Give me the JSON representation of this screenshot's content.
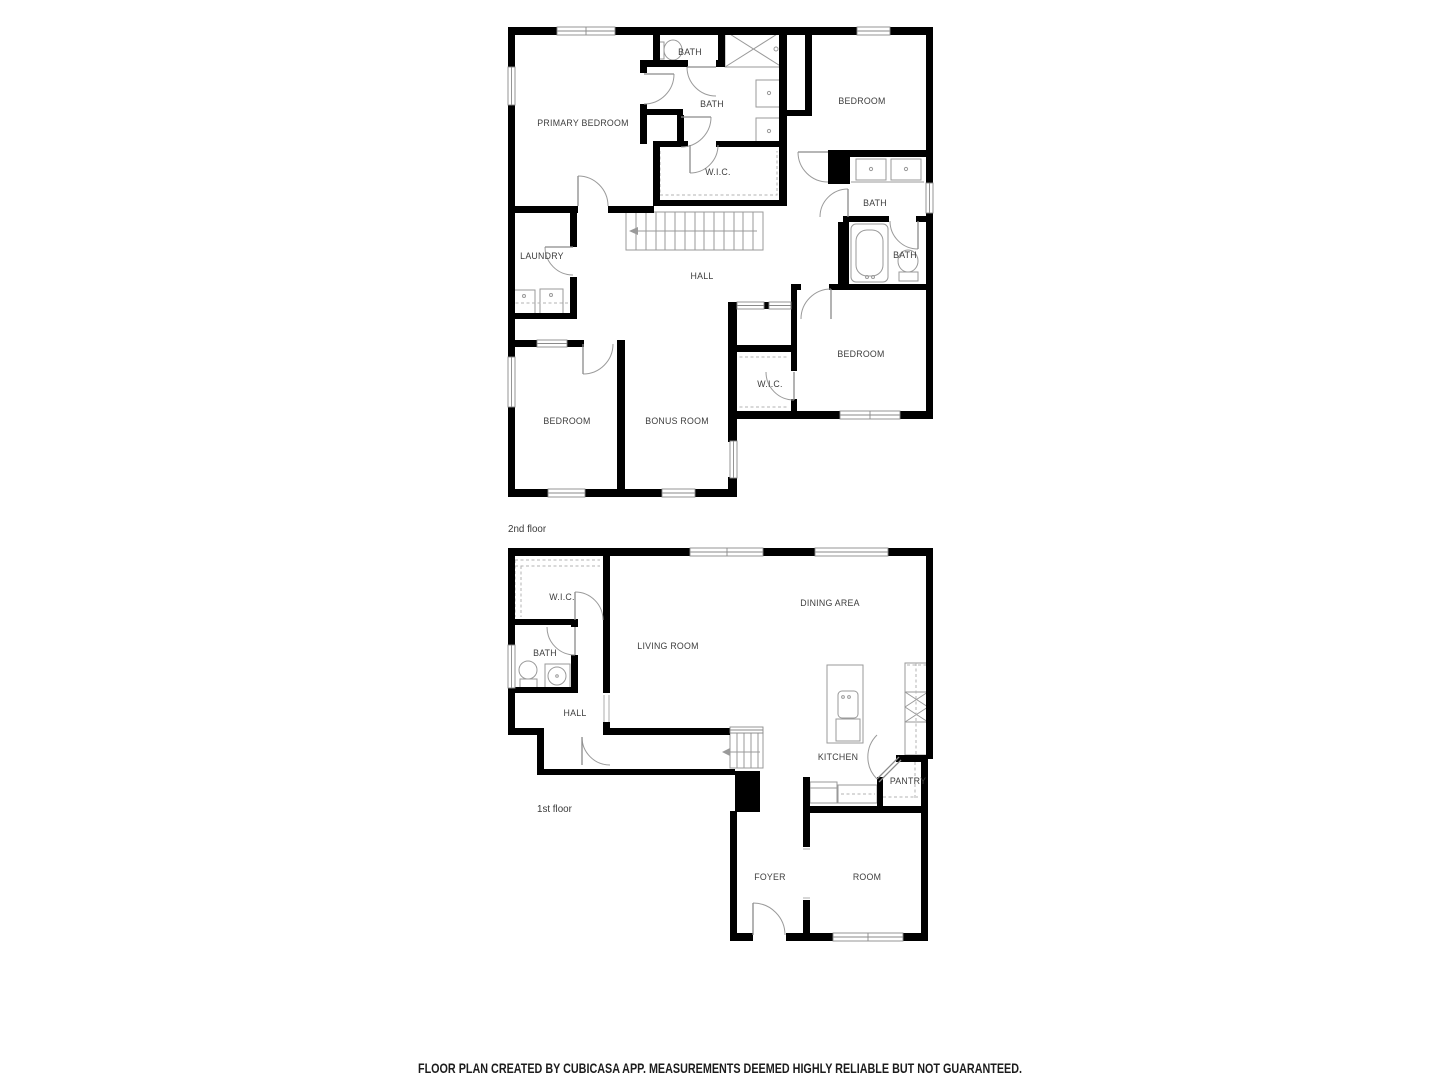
{
  "second_floor": {
    "label": "2nd floor",
    "rooms": {
      "primary_bedroom": "PRIMARY BEDROOM",
      "bath_top": "BATH",
      "bath_main": "BATH",
      "wic_primary": "W.I.C.",
      "bedroom_top_right": "BEDROOM",
      "bath_right_upper": "BATH",
      "bath_right_lower": "BATH",
      "laundry": "LAUNDRY",
      "hall": "HALL",
      "bedroom_bottom_right": "BEDROOM",
      "wic_bedroom": "W.I.C.",
      "bedroom_bottom_left": "BEDROOM",
      "bonus_room": "BONUS ROOM"
    }
  },
  "first_floor": {
    "label": "1st floor",
    "rooms": {
      "wic": "W.I.C.",
      "dining_area": "DINING AREA",
      "living_room": "LIVING ROOM",
      "bath": "BATH",
      "hall": "HALL",
      "kitchen": "KITCHEN",
      "pantry": "PANTRY",
      "foyer": "FOYER",
      "room": "ROOM"
    }
  },
  "footer": {
    "disclaimer": "FLOOR PLAN CREATED BY CUBICASA APP. MEASUREMENTS DEEMED HIGHLY RELIABLE BUT NOT GUARANTEED."
  },
  "colors": {
    "wall": "#000000",
    "fixture": "#9a9a9a",
    "dashed": "#b3b3b3",
    "label": "#3d3d3d"
  }
}
